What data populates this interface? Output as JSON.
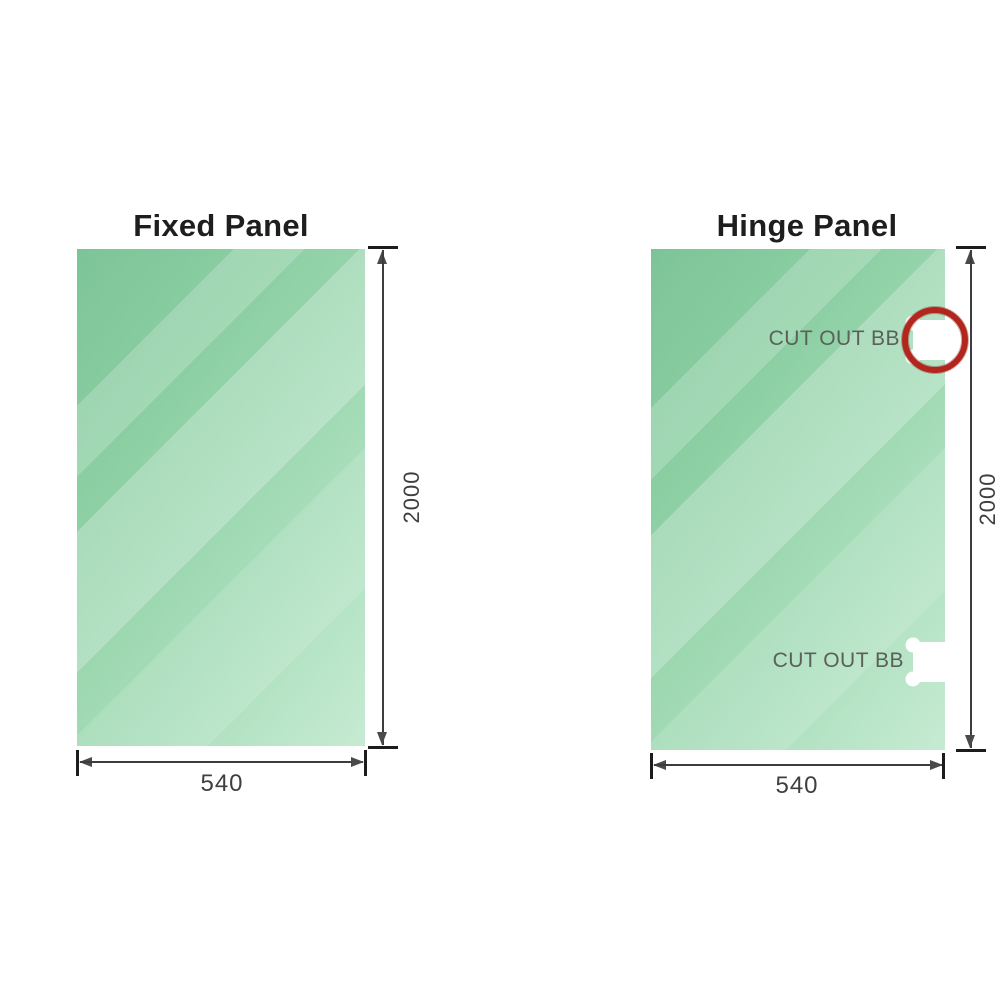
{
  "diagram_title": "Shower screen panel cut-out diagram",
  "panels": [
    {
      "id": "fixed",
      "title": "Fixed Panel",
      "height_dim": "2000",
      "width_dim": "540",
      "cutouts": []
    },
    {
      "id": "hinge",
      "title": "Hinge Panel",
      "height_dim": "2000",
      "width_dim": "540",
      "cutouts": [
        {
          "label": "CUT OUT BB",
          "position": "top",
          "highlighted": true
        },
        {
          "label": "CUT OUT BB",
          "position": "bottom",
          "highlighted": false
        }
      ]
    }
  ],
  "colors": {
    "glass_dark": "#7cc497",
    "glass_light": "#c6ebd2",
    "dimension_line": "#3d3d3d",
    "tick": "#1c1c1c",
    "arrow": "#4a4a4a",
    "dim_text": "#3f3f3f",
    "cutout_text": "#5a605a",
    "highlight_ring": "#b2261e",
    "title_text": "#1e1e1e",
    "background": "#ffffff"
  }
}
